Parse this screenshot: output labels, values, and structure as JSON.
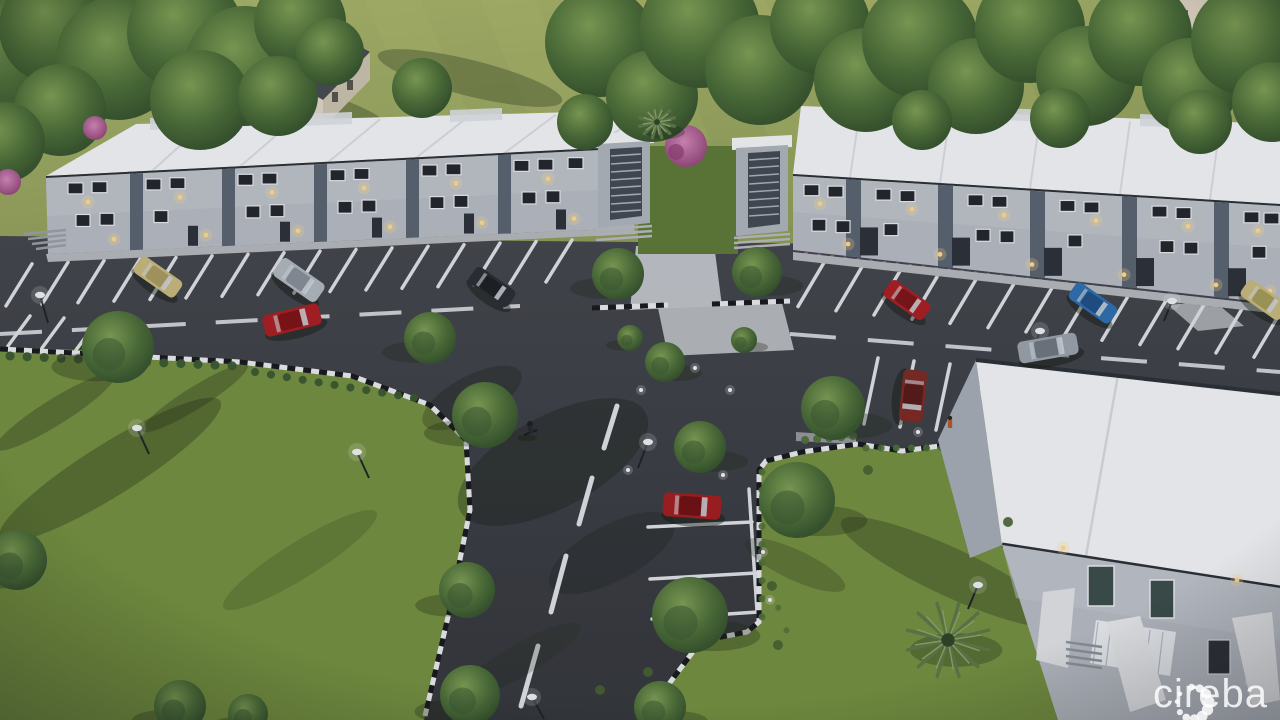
{
  "watermark": {
    "text": "cireba",
    "logo": "cireba-flower-dots-logo"
  },
  "scene": {
    "type": "architectural-aerial-render",
    "description": "Dusk aerial rendering of a two-storey townhome development with two long residential blocks, a closer building with balcony, parking lots with angled stalls, an entry road with dashed centerline, lawns, trees and palm trees",
    "objects": [
      "left-townhome-block",
      "right-townhome-block",
      "foreground-building",
      "central-stair-towers",
      "entry-road",
      "parking-lot",
      "parking-bay",
      "lawns",
      "trees",
      "palm-tree",
      "street-lamps",
      "cars",
      "cyclist",
      "pedestrian"
    ]
  },
  "palette": {
    "field": "#9fab61",
    "fieldStripe": "#b2bd6f",
    "lawn": "#74903f",
    "lawnShade": "#5e7a33",
    "treeDark": "#3a5830",
    "treeMid": "#4e7038",
    "treeLight": "#7a9a50",
    "road": "#3a3d41",
    "roadDark": "#2e3135",
    "roofWhite": "#f3f4f6",
    "roofShade": "#dde0e4",
    "seam": "#d3d7db",
    "wall": "#b6bbc1",
    "wallShade": "#9aa1a9",
    "accent": "#5a646f",
    "trim": "#2c3136",
    "path": "#c6c9cc",
    "marking": "#dde0e2",
    "flowerPink": "#a85890",
    "flowerBlue": "#7f8fc0",
    "lightWarm": "#ffd98c",
    "carRed": "#a81f22",
    "carMaroon": "#7c2a23",
    "carBlue": "#2f6fae",
    "carTan": "#c6b97c",
    "carSilver": "#b0b7bd",
    "carDark": "#2b2e32",
    "watermark": "rgba(255,255,255,0.84)"
  }
}
